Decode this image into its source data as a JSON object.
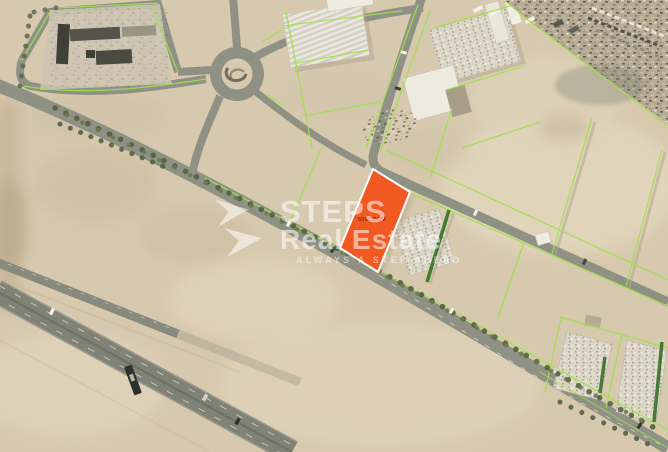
{
  "map": {
    "plot": {
      "area_label": "5000 SQM",
      "fill": "#F05A22",
      "border": "#FFFFFF",
      "label_color": "#8E2F07"
    },
    "boundaries_color": "#9FE14D",
    "hedge_color": "#2E6B1D",
    "road_color": "#8E9183",
    "sand_color": "#D7C9AE"
  },
  "watermark": {
    "brand": "STEPS",
    "brand_line2": "Real Estate",
    "tagline": "ALWAYS A STEP AHEAD",
    "color": "#FFFFFF"
  }
}
